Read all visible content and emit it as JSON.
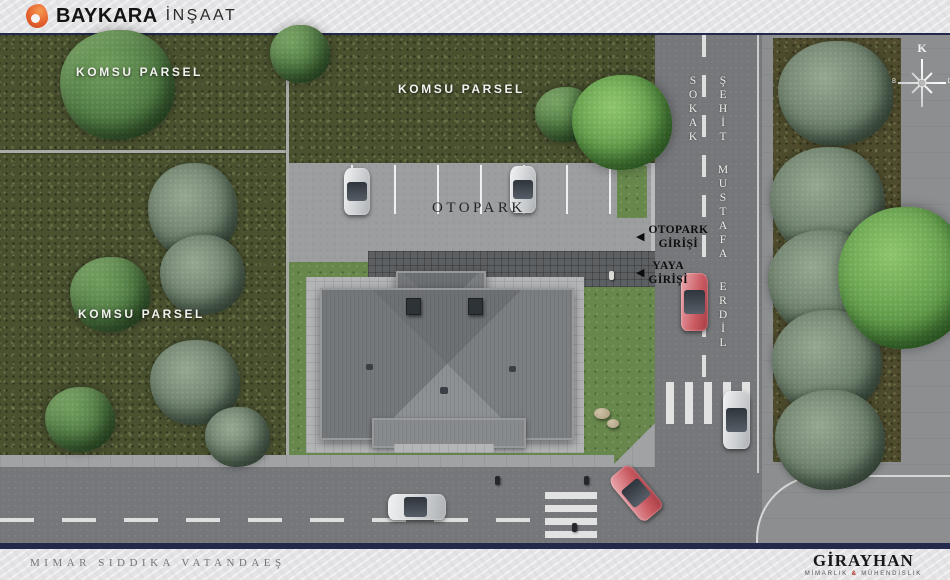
{
  "header": {
    "brand": "BAYKARA",
    "suffix": "İNŞAAT"
  },
  "plan": {
    "parcels": {
      "left_top": "KOMSU PARSEL",
      "left_bottom": "KOMSU PARSEL",
      "middle": "KOMSU PARSEL"
    },
    "parking": {
      "label": "OTOPARK"
    },
    "entrances": {
      "parking_line1": "OTOPARK",
      "parking_line2": "GİRİŞİ",
      "pedestrian_line1": "YAYA",
      "pedestrian_line2": "GİRİŞİ"
    },
    "street": {
      "name": "ŞEHİT MUSTAFA ERDİL SOKAK"
    },
    "compass": {
      "north": "K",
      "west": "B",
      "east": "D"
    }
  },
  "footer": {
    "credit": "MIMAR SIDDIKA VATANDAEŞ",
    "firm": "GİRAYHAN",
    "firm_sub_left": "MİMARLIK",
    "firm_sub_amp": "&",
    "firm_sub_right": "MÜHENDİSLİK"
  },
  "icons": {
    "arrow_left": "◀"
  },
  "colors": {
    "accent_orange": "#e4612e",
    "navy": "#23294a",
    "firm_red": "#b23028",
    "road": "#75777a",
    "parking": "#9c9ea0",
    "lawn": "#67874d",
    "grass": "#49512f",
    "roof": "#7d8083",
    "bar_bg": "#e4e4e6"
  }
}
